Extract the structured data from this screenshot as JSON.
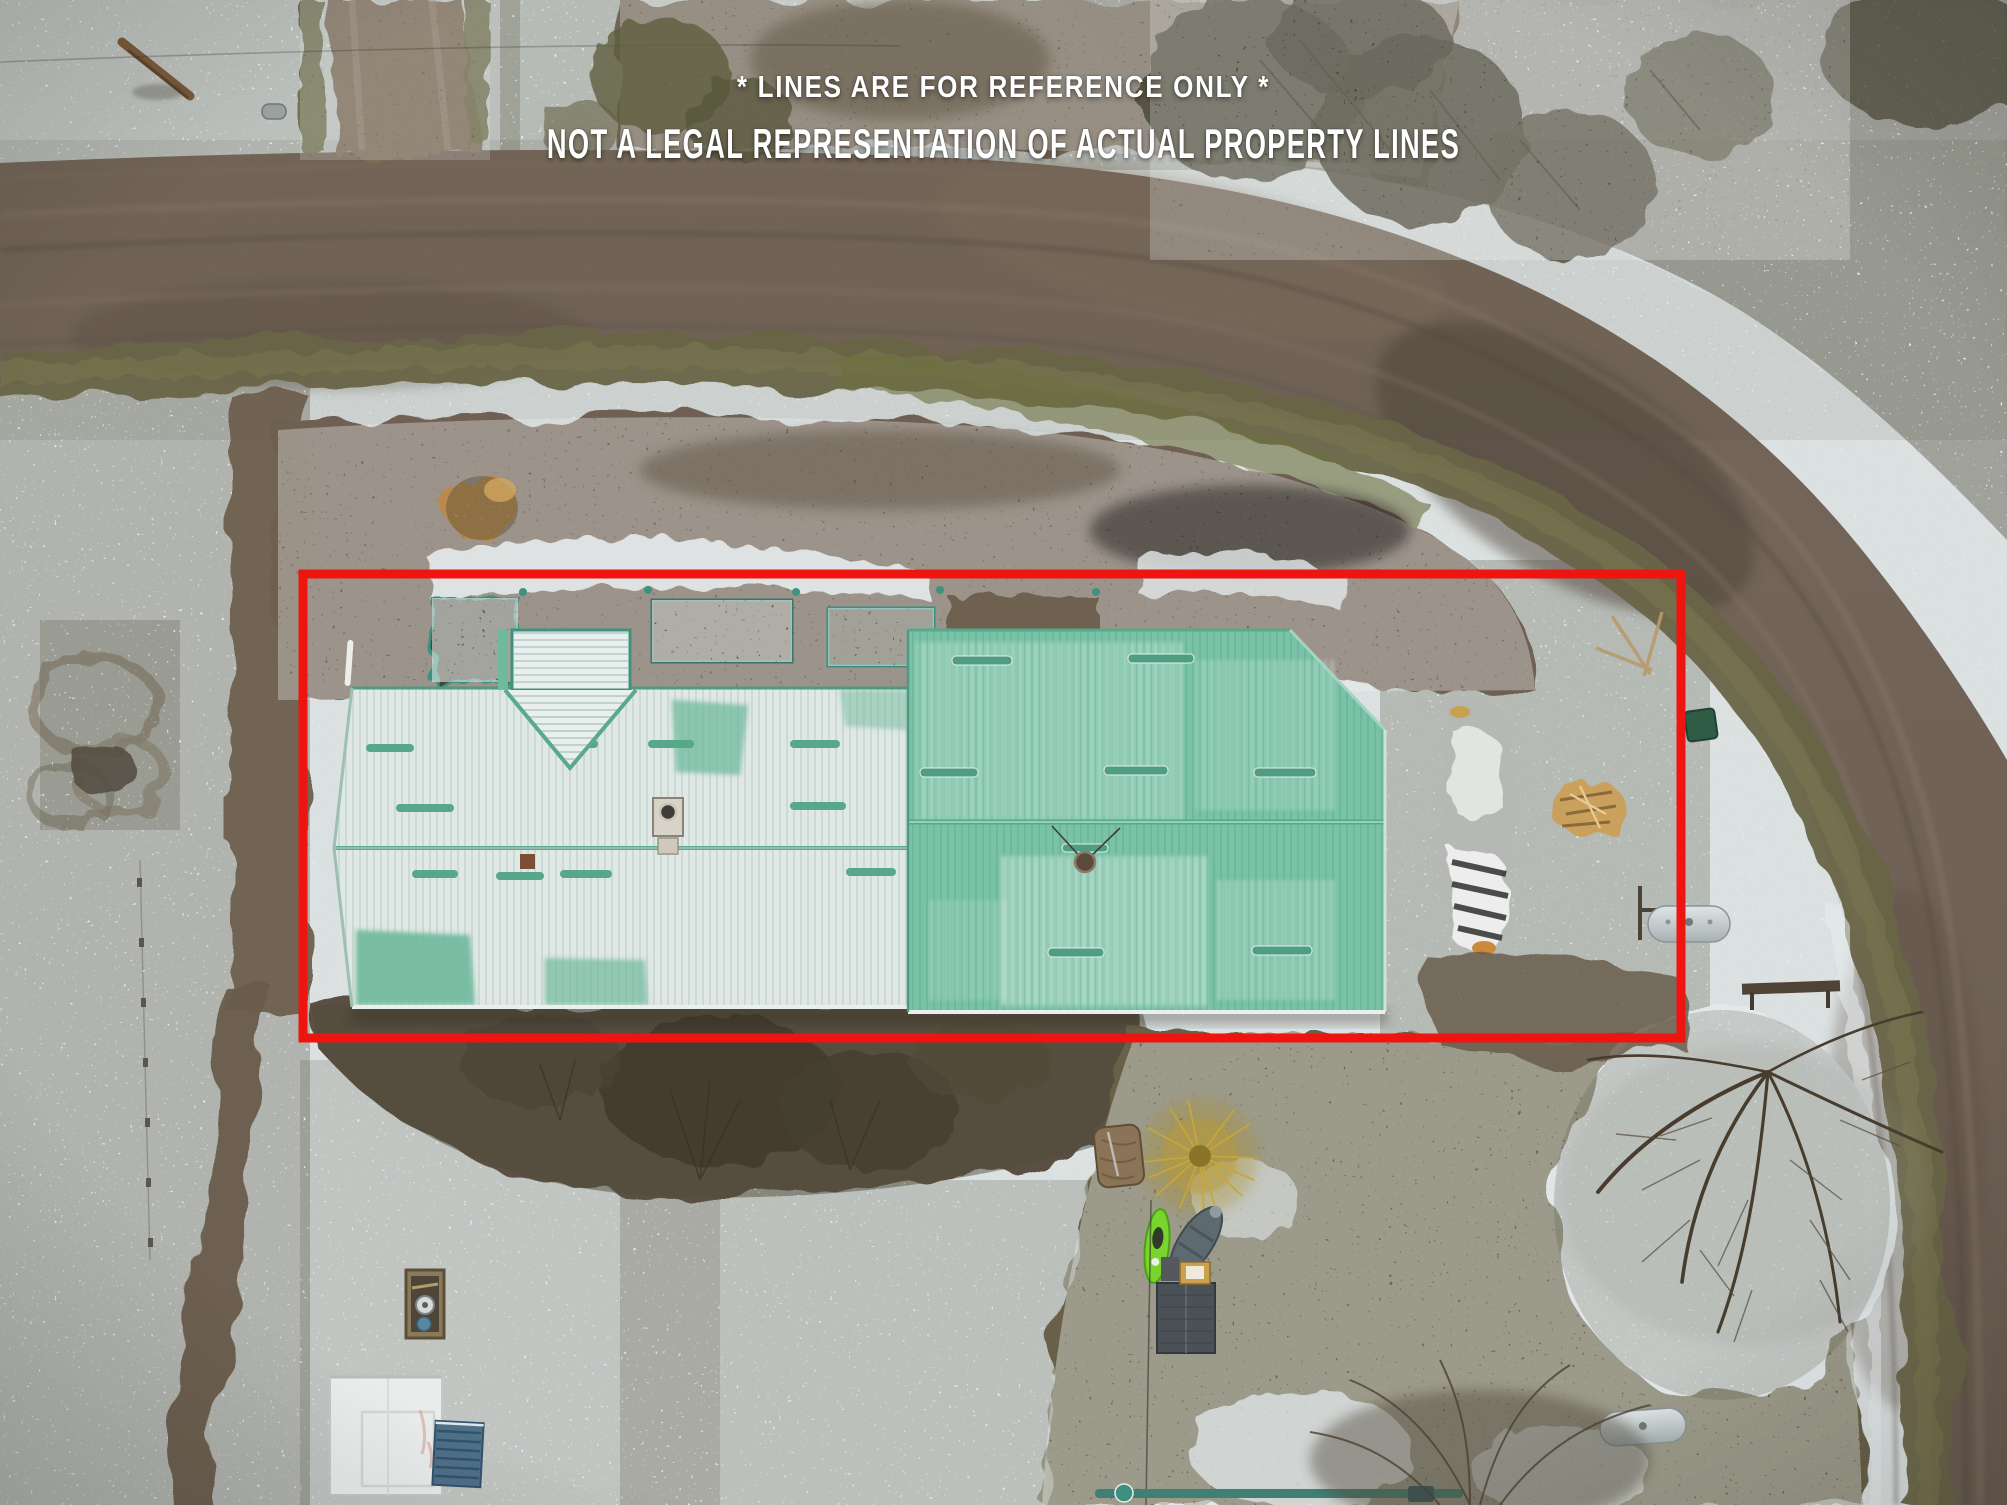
{
  "overlay": {
    "line1": "* LINES ARE FOR REFERENCE ONLY *",
    "line2": "NOT A LEGAL REPRESENTATION OF ACTUAL PROPERTY LINES"
  },
  "colors": {
    "boundary_red": "#ee1410",
    "roof_green": "#79c2a6",
    "roof_snow": "#dfe8e5",
    "snow": "#e7edef",
    "road": "#6f6156",
    "kayak_green": "#79d42d",
    "text_white": "#ffffff"
  }
}
